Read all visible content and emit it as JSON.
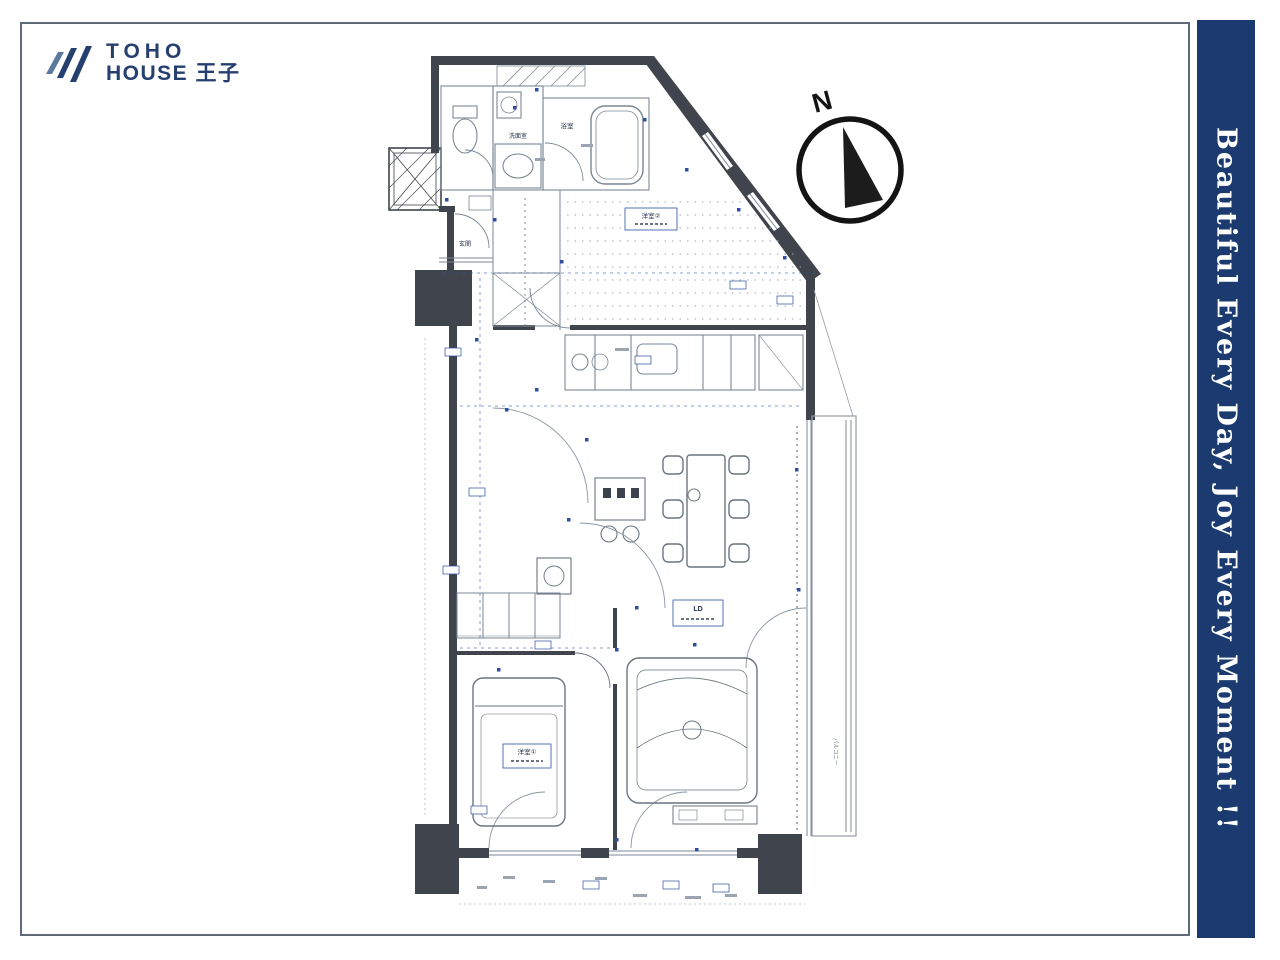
{
  "page": {
    "background": "#ffffff",
    "frame_color": "#5f6b7a"
  },
  "logo": {
    "line1": "TOHO",
    "line2": "HOUSE 王子",
    "color": "#25406f",
    "icon": "triple-chevron-wing"
  },
  "banner": {
    "text": "Beautiful  Every Day, Joy Every Moment !!",
    "bg_color": "#1b3a70",
    "text_color": "#ffffff"
  },
  "compass": {
    "label": "N"
  },
  "floorplan": {
    "wall_color": "#40454d",
    "line_color": "#7b8794",
    "annotation_color": "#2b4fa3",
    "labels": {
      "washroom": "洗面室",
      "bathroom": "浴室",
      "entrance": "玄関",
      "bedroom2": "洋室②",
      "living_dining": "LD",
      "bedroom1": "洋室①",
      "balcony": "バルコニー"
    }
  }
}
